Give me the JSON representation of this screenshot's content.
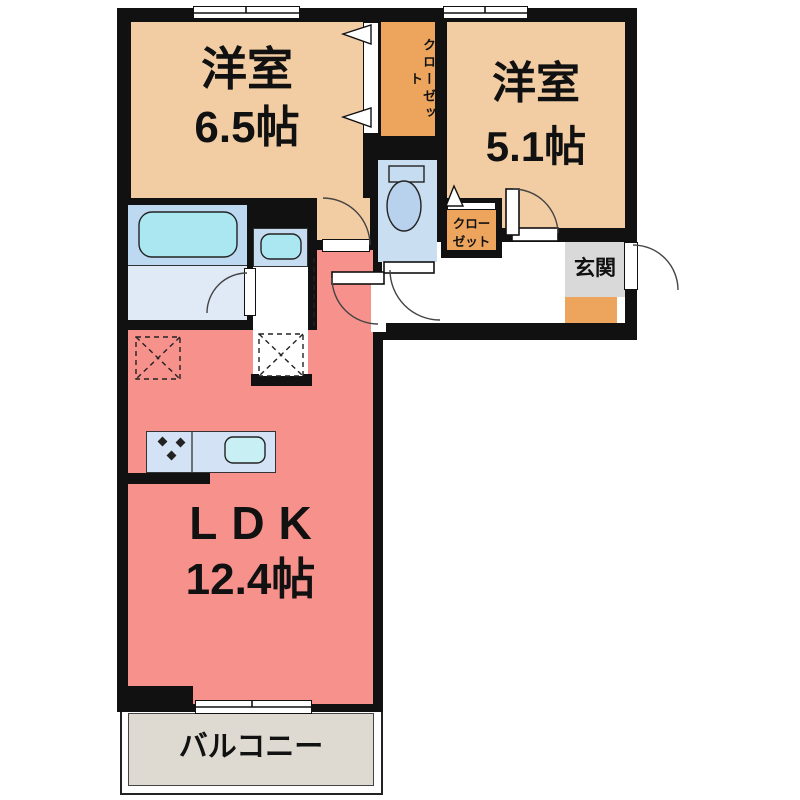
{
  "title": "2LDK floor plan",
  "rooms": {
    "bedroom1": {
      "label": "洋室",
      "size": "6.5帖"
    },
    "bedroom2": {
      "label": "洋室",
      "size": "5.1帖"
    },
    "ldk": {
      "label": "LDK",
      "size": "12.4帖"
    },
    "balcony": {
      "label": "バルコニー"
    },
    "entrance": {
      "label": "玄関"
    },
    "closet_main": {
      "label": "クローゼット"
    },
    "closet_small": {
      "line1": "クロー",
      "line2": "ゼット"
    }
  },
  "colors": {
    "wall": "#111111",
    "room_beige": "#f2cda4",
    "closet_orange": "#eda55e",
    "ldk_salmon": "#f7918c",
    "balcony_gray": "#dedad1",
    "entrance_gray": "#d9d9d9",
    "bath_blue": "#bdd8f1",
    "washroom_blue": "#e0eaf6",
    "fixture_blue": "#c6dcf1",
    "water_cyan": "#abe7f1",
    "toilet_blue": "#cadef2",
    "counter_blue": "#d3e3f5"
  }
}
